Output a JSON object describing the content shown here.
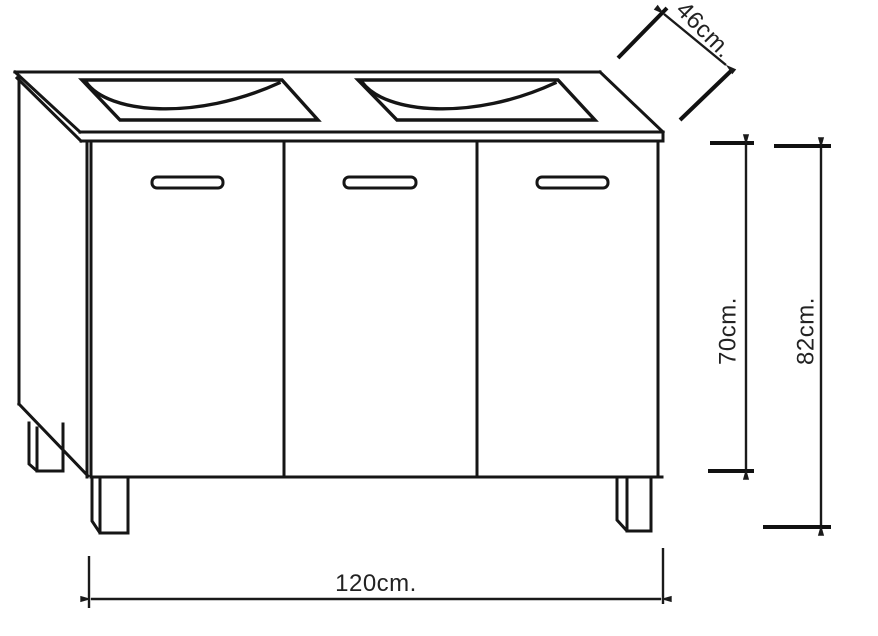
{
  "drawing": {
    "subject": "vanity-cabinet-technical-drawing",
    "colors": {
      "line": "#151515",
      "background": "#ffffff"
    }
  },
  "dimensions": {
    "depth": "46cm.",
    "door_height": "70cm.",
    "overall_height": "82cm.",
    "width": "120cm."
  }
}
